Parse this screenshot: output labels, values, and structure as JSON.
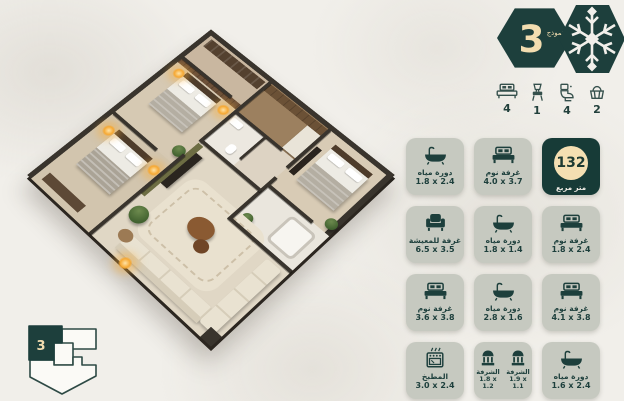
{
  "badge": {
    "number": "3",
    "label": "نموذج"
  },
  "summary": {
    "items": [
      {
        "icon": "bed-icon",
        "count": "4"
      },
      {
        "icon": "chair-icon",
        "count": "1"
      },
      {
        "icon": "toilet-icon",
        "count": "4"
      },
      {
        "icon": "basket-icon",
        "count": "2"
      }
    ]
  },
  "cards": [
    {
      "icon": "bathtub-icon",
      "label": "دورة مياه",
      "dims": "1.8 x 2.4"
    },
    {
      "icon": "bed-icon",
      "label": "غرفة نوم",
      "dims": "4.0 x 3.7"
    },
    {
      "type": "area",
      "value": "132",
      "unit": "متر مربع"
    },
    {
      "icon": "armchair-icon",
      "label": "غرفة للمعيشة",
      "dims": "6.5 x 3.5"
    },
    {
      "icon": "bathtub-icon",
      "label": "دورة مياه",
      "dims": "1.8 x 1.4"
    },
    {
      "icon": "bed-icon",
      "label": "غرفة نوم",
      "dims": "1.8 x 2.4"
    },
    {
      "icon": "bed-icon",
      "label": "غرفة نوم",
      "dims": "3.6 x 3.8"
    },
    {
      "icon": "bathtub-icon",
      "label": "دورة مياه",
      "dims": "2.8 x 1.6"
    },
    {
      "icon": "bed-icon",
      "label": "غرفة نوم",
      "dims": "4.1 x 3.8"
    },
    {
      "icon": "stove-icon",
      "label": "المطبخ",
      "dims": "3.0 x 2.4"
    },
    {
      "type": "balcony-double",
      "items": [
        {
          "icon": "balcony-icon",
          "label": "الشرفة",
          "dims": "1.8 x 1.2"
        },
        {
          "icon": "balcony-icon",
          "label": "الشرفة",
          "dims": "1.9 x 1.1"
        }
      ]
    },
    {
      "icon": "bathtub-icon",
      "label": "دورة مياه",
      "dims": "1.6 x 2.4"
    }
  ],
  "mini_plan": {
    "unit_number": "3"
  },
  "colors": {
    "teal": "#1d3f3c",
    "cream": "#f2ddb0",
    "card_bg": "#c6c9c0"
  }
}
